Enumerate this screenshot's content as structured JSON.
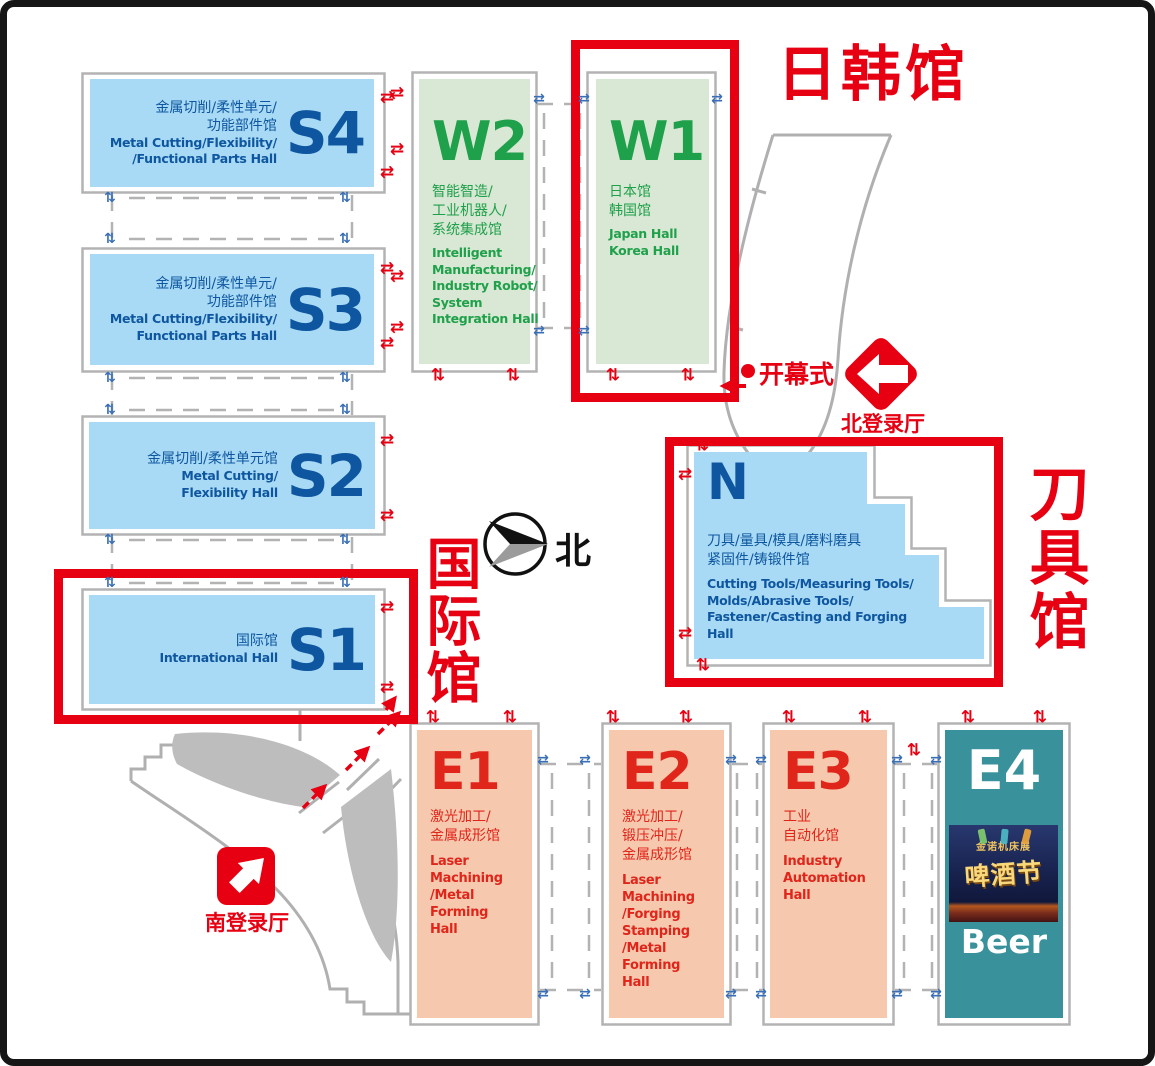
{
  "colors": {
    "accent_red": "#e60012",
    "hall_blue_fill": "#a9daf5",
    "hall_blue_text": "#0e57a0",
    "hall_green_fill": "#d9e8d4",
    "hall_green_text": "#1fa04a",
    "hall_salmon_fill": "#f6c9ae",
    "hall_red_text": "#e0251b",
    "hall_teal_fill": "#38919b",
    "outline_gray": "#b3b3b3",
    "arrow_blue": "#3a6fb5"
  },
  "icons": {
    "h_arrows": "⇄",
    "v_arrows": "⇅"
  },
  "compass": {
    "label": "北"
  },
  "regions": {
    "japan_korea": "日韩馆",
    "cutting_tools": "刀具馆",
    "international": "国际馆"
  },
  "markers": {
    "opening_ceremony": "开幕式",
    "north_registration": "北登录厅",
    "south_registration": "南登录厅"
  },
  "halls": {
    "s4": {
      "code": "S4",
      "zh": "金属切削/柔性单元/\n功能部件馆",
      "en": "Metal Cutting/Flexibility/\n/Functional Parts Hall"
    },
    "s3": {
      "code": "S3",
      "zh": "金属切削/柔性单元/\n功能部件馆",
      "en": "Metal Cutting/Flexibility/\nFunctional Parts Hall"
    },
    "s2": {
      "code": "S2",
      "zh": "金属切削/柔性单元馆",
      "en": "Metal Cutting/\nFlexibility Hall"
    },
    "s1": {
      "code": "S1",
      "zh": "国际馆",
      "en": "International Hall"
    },
    "w2": {
      "code": "W2",
      "zh": "智能智造/\n工业机器人/\n系统集成馆",
      "en": "Intelligent\nManufacturing/\nIndustry Robot/\nSystem\nIntegration Hall"
    },
    "w1": {
      "code": "W1",
      "zh": "日本馆\n韩国馆",
      "en": "Japan Hall\nKorea Hall"
    },
    "n": {
      "code": "N",
      "zh": "刀具/量具/模具/磨料磨具\n紧固件/铸锻件馆",
      "en": "Cutting Tools/Measuring Tools/\nMolds/Abrasive Tools/\nFastener/Casting and Forging\nHall"
    },
    "e1": {
      "code": "E1",
      "zh": "激光加工/\n金属成形馆",
      "en": "Laser\nMachining\n/Metal\nForming\nHall"
    },
    "e2": {
      "code": "E2",
      "zh": "激光加工/\n锻压冲压/\n金属成形馆",
      "en": "Laser\nMachining\n/Forging\nStamping\n/Metal\nForming\nHall"
    },
    "e3": {
      "code": "E3",
      "zh": "工业\n自动化馆",
      "en": "Industry\nAutomation\nHall"
    },
    "e4": {
      "code": "E4",
      "beer_label": "Beer"
    }
  },
  "poster": {
    "banner": "金诺机床展",
    "title": "啤酒节"
  },
  "arrow_markers": [
    {
      "t": "h",
      "c": "r",
      "x": 380,
      "y": 91
    },
    {
      "t": "h",
      "c": "r",
      "x": 380,
      "y": 166
    },
    {
      "t": "h",
      "c": "r",
      "x": 380,
      "y": 262
    },
    {
      "t": "h",
      "c": "r",
      "x": 380,
      "y": 337
    },
    {
      "t": "h",
      "c": "r",
      "x": 380,
      "y": 434
    },
    {
      "t": "h",
      "c": "r",
      "x": 380,
      "y": 509
    },
    {
      "t": "h",
      "c": "r",
      "x": 380,
      "y": 601
    },
    {
      "t": "h",
      "c": "r",
      "x": 380,
      "y": 681
    },
    {
      "t": "h",
      "c": "r",
      "x": 390,
      "y": 87
    },
    {
      "t": "h",
      "c": "r",
      "x": 390,
      "y": 143
    },
    {
      "t": "h",
      "c": "r",
      "x": 390,
      "y": 270
    },
    {
      "t": "h",
      "c": "r",
      "x": 390,
      "y": 321
    },
    {
      "t": "h",
      "c": "r",
      "x": 678,
      "y": 468
    },
    {
      "t": "h",
      "c": "r",
      "x": 678,
      "y": 627
    },
    {
      "t": "v",
      "c": "r",
      "x": 431,
      "y": 369
    },
    {
      "t": "v",
      "c": "r",
      "x": 506,
      "y": 369
    },
    {
      "t": "v",
      "c": "r",
      "x": 606,
      "y": 369
    },
    {
      "t": "v",
      "c": "r",
      "x": 681,
      "y": 369
    },
    {
      "t": "v",
      "c": "r",
      "x": 695,
      "y": 439
    },
    {
      "t": "v",
      "c": "r",
      "x": 696,
      "y": 659
    },
    {
      "t": "v",
      "c": "r",
      "x": 426,
      "y": 711
    },
    {
      "t": "v",
      "c": "r",
      "x": 503,
      "y": 711
    },
    {
      "t": "v",
      "c": "r",
      "x": 606,
      "y": 711
    },
    {
      "t": "v",
      "c": "r",
      "x": 679,
      "y": 711
    },
    {
      "t": "v",
      "c": "r",
      "x": 782,
      "y": 711
    },
    {
      "t": "v",
      "c": "r",
      "x": 858,
      "y": 711
    },
    {
      "t": "v",
      "c": "r",
      "x": 961,
      "y": 711
    },
    {
      "t": "v",
      "c": "r",
      "x": 1033,
      "y": 711
    },
    {
      "t": "v",
      "c": "r",
      "x": 907,
      "y": 744
    },
    {
      "t": "v",
      "c": "b",
      "x": 103,
      "y": 191
    },
    {
      "t": "v",
      "c": "b",
      "x": 338,
      "y": 191
    },
    {
      "t": "v",
      "c": "b",
      "x": 103,
      "y": 232
    },
    {
      "t": "v",
      "c": "b",
      "x": 338,
      "y": 232
    },
    {
      "t": "v",
      "c": "b",
      "x": 103,
      "y": 371
    },
    {
      "t": "v",
      "c": "b",
      "x": 338,
      "y": 371
    },
    {
      "t": "v",
      "c": "b",
      "x": 103,
      "y": 403
    },
    {
      "t": "v",
      "c": "b",
      "x": 338,
      "y": 403
    },
    {
      "t": "v",
      "c": "b",
      "x": 103,
      "y": 533
    },
    {
      "t": "v",
      "c": "b",
      "x": 338,
      "y": 533
    },
    {
      "t": "v",
      "c": "b",
      "x": 103,
      "y": 576
    },
    {
      "t": "v",
      "c": "b",
      "x": 338,
      "y": 576
    },
    {
      "t": "h",
      "c": "b",
      "x": 532,
      "y": 92
    },
    {
      "t": "h",
      "c": "b",
      "x": 577,
      "y": 92
    },
    {
      "t": "h",
      "c": "b",
      "x": 710,
      "y": 92
    },
    {
      "t": "h",
      "c": "b",
      "x": 532,
      "y": 324
    },
    {
      "t": "h",
      "c": "b",
      "x": 577,
      "y": 324
    },
    {
      "t": "h",
      "c": "b",
      "x": 536,
      "y": 753
    },
    {
      "t": "h",
      "c": "b",
      "x": 578,
      "y": 753
    },
    {
      "t": "h",
      "c": "b",
      "x": 536,
      "y": 987
    },
    {
      "t": "h",
      "c": "b",
      "x": 578,
      "y": 987
    },
    {
      "t": "h",
      "c": "b",
      "x": 724,
      "y": 753
    },
    {
      "t": "h",
      "c": "b",
      "x": 754,
      "y": 753
    },
    {
      "t": "h",
      "c": "b",
      "x": 724,
      "y": 987
    },
    {
      "t": "h",
      "c": "b",
      "x": 754,
      "y": 987
    },
    {
      "t": "h",
      "c": "b",
      "x": 890,
      "y": 753
    },
    {
      "t": "h",
      "c": "b",
      "x": 929,
      "y": 753
    },
    {
      "t": "h",
      "c": "b",
      "x": 890,
      "y": 987
    },
    {
      "t": "h",
      "c": "b",
      "x": 929,
      "y": 987
    }
  ]
}
